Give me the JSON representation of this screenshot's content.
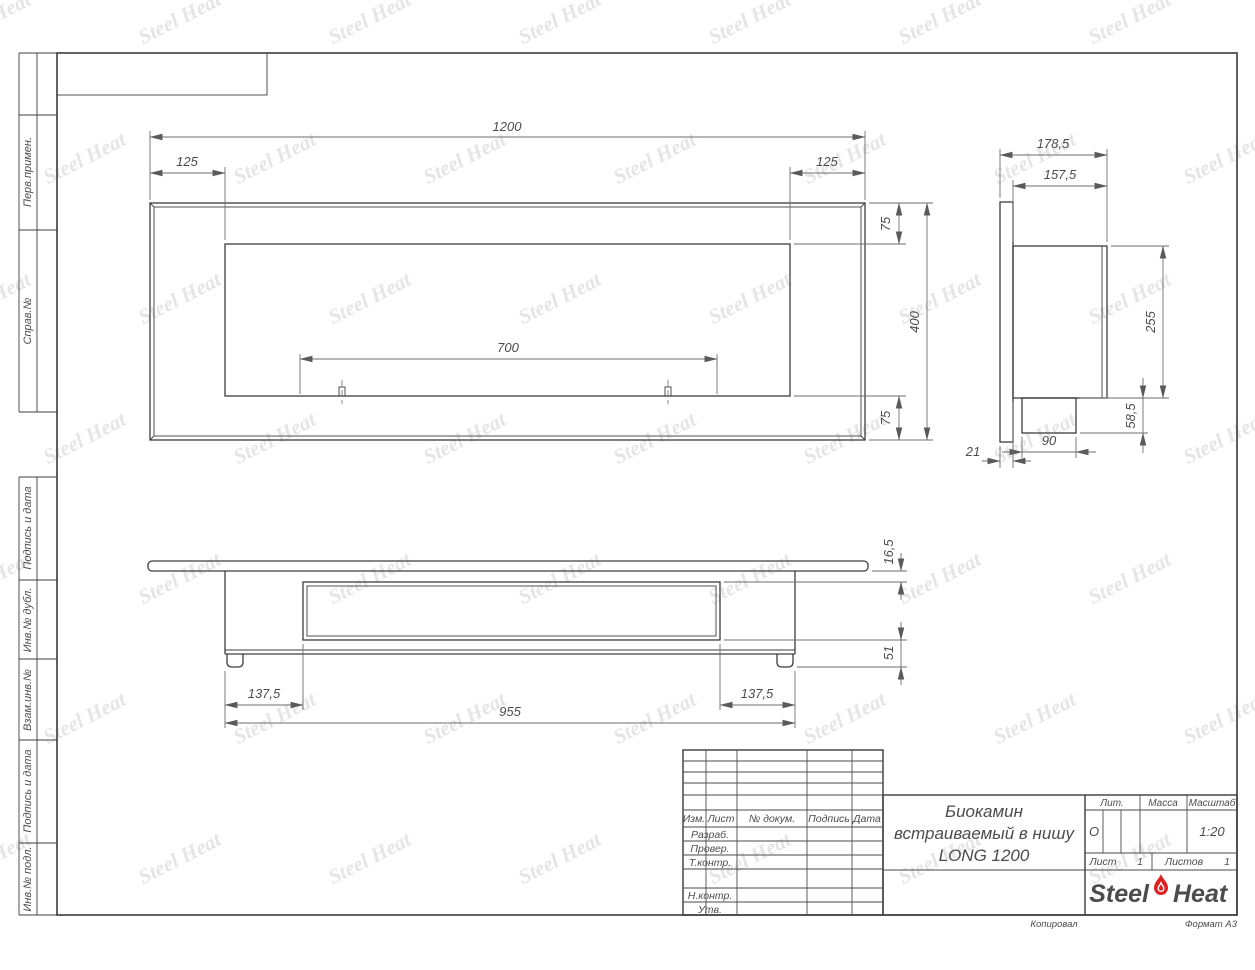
{
  "watermark": {
    "text": "Steel Heat"
  },
  "sidebar": {
    "labels": [
      "Перв.примен.",
      "Справ.№",
      "Подпись и дата",
      "Инв.№ дубл.",
      "Взам.инв.№",
      "Подпись и дата",
      "Инв.№ подл."
    ]
  },
  "views": {
    "front": {
      "dims": {
        "width": "1200",
        "left_offset": "125",
        "right_offset": "125",
        "top_offset": "75",
        "height": "400",
        "bottom_offset": "75",
        "burner_width": "700"
      }
    },
    "side": {
      "dims": {
        "depth_total": "178,5",
        "depth_body": "157,5",
        "body_height": "255",
        "tray_height": "58,5",
        "tray_width": "90",
        "flange_thickness": "21"
      }
    },
    "plan": {
      "dims": {
        "plate_thickness": "16,5",
        "inner_drop": "51",
        "left_offset": "137,5",
        "right_offset": "137,5",
        "body_width": "955"
      }
    }
  },
  "title_block": {
    "header_cols": [
      "Изм.",
      "Лист",
      "№ докум.",
      "Подпись",
      "Дата"
    ],
    "rows": [
      "Разраб.",
      "Провер.",
      "Т.контр.",
      "Н.контр.",
      "Утв."
    ],
    "name_line1": "Биокамин",
    "name_line2": "встраиваемый в нишу",
    "name_line3": "LONG 1200",
    "lit_label": "Лит.",
    "lit_value": "О",
    "massa_label": "Масса",
    "masshtab_label": "Масштаб",
    "masshtab_value": "1:20",
    "sheet_label": "Лист",
    "sheet_value": "1",
    "sheets_label": "Листов",
    "sheets_value": "1",
    "logo_steel": "Steel",
    "logo_heat": "Heat",
    "kopiroval": "Копировал",
    "format": "Формат А3"
  },
  "colors": {
    "accent_flame": "#e02020",
    "line": "#3d3d3d",
    "dim": "#6e6e6e",
    "watermark": "#cccccc"
  }
}
